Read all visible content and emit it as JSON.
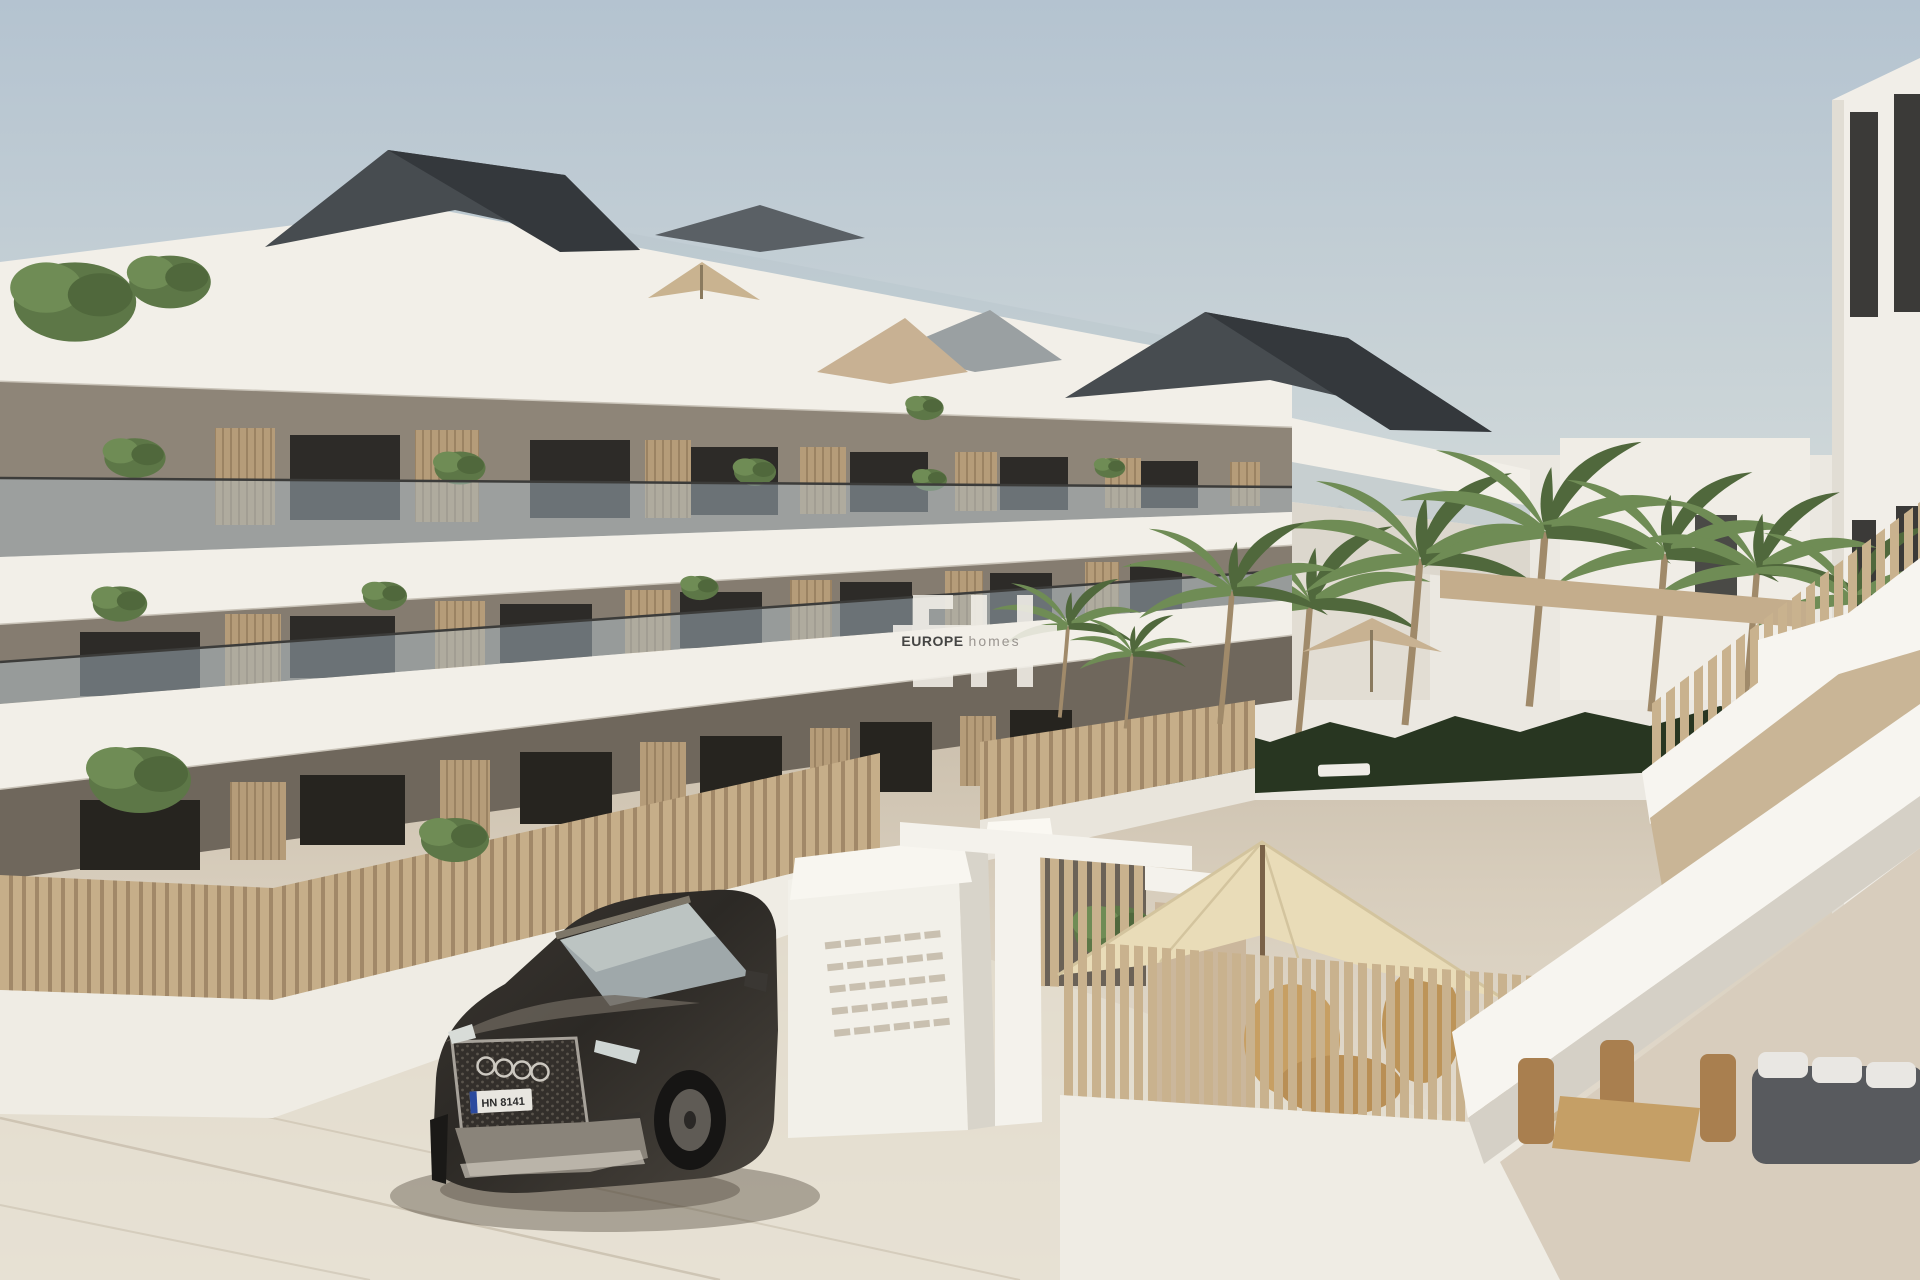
{
  "image": {
    "type": "3d-architectural-render",
    "description": "New-build modern three-storey apartment complex with white fascia bands, glass balconies and wooden slat screens; gated entrance with mailbox wall, dark SUV parked in front, palm-lined pool garden, exterior staircase and patio seating",
    "width_px": 1920,
    "height_px": 1280
  },
  "watermark": {
    "logo": "EH",
    "brand": "EUROPE",
    "brand_suffix": "homes"
  },
  "car": {
    "make_hint": "audi-rings",
    "license_plate": "HN 8141"
  },
  "scene_counts": {
    "building_floors": 3,
    "palm_trees": 9,
    "umbrellas": 2
  },
  "palette": {
    "sky_top": "#b4c3d0",
    "sky_low": "#e0e3e1",
    "band_white": "#f2efe8",
    "band_shadow": "#d9d4c9",
    "wall_taupe": "#8e8578",
    "wall_taupe2": "#857c70",
    "wall_taupe_dark": "#6f675c",
    "window_dark": "#2d2b28",
    "slat_wood": "#c6ae89",
    "slat_gap": "#a18868",
    "screen_wood": "#b59c79",
    "glass": "#a9bac3",
    "roof_dark": "#474c50",
    "roof_dark2": "#34383c",
    "hedge": "#283621",
    "palm": "#6f8c55",
    "palm_dark": "#50683c",
    "trunk": "#a08a6a",
    "umbrella": "#e9dcb8",
    "umbrella_edge": "#d3c49e",
    "ground": "#d3c8b6",
    "ground_light": "#e7e1d5",
    "white_wall": "#efece4",
    "tan_wall": "#c9b596",
    "furniture_tan": "#c29b63",
    "car_body": "#2f2c28",
    "car_body_light": "#55504a",
    "watermark_white": "#f3f0e9",
    "text_dark": "#454543",
    "text_gray": "#9a9590"
  }
}
